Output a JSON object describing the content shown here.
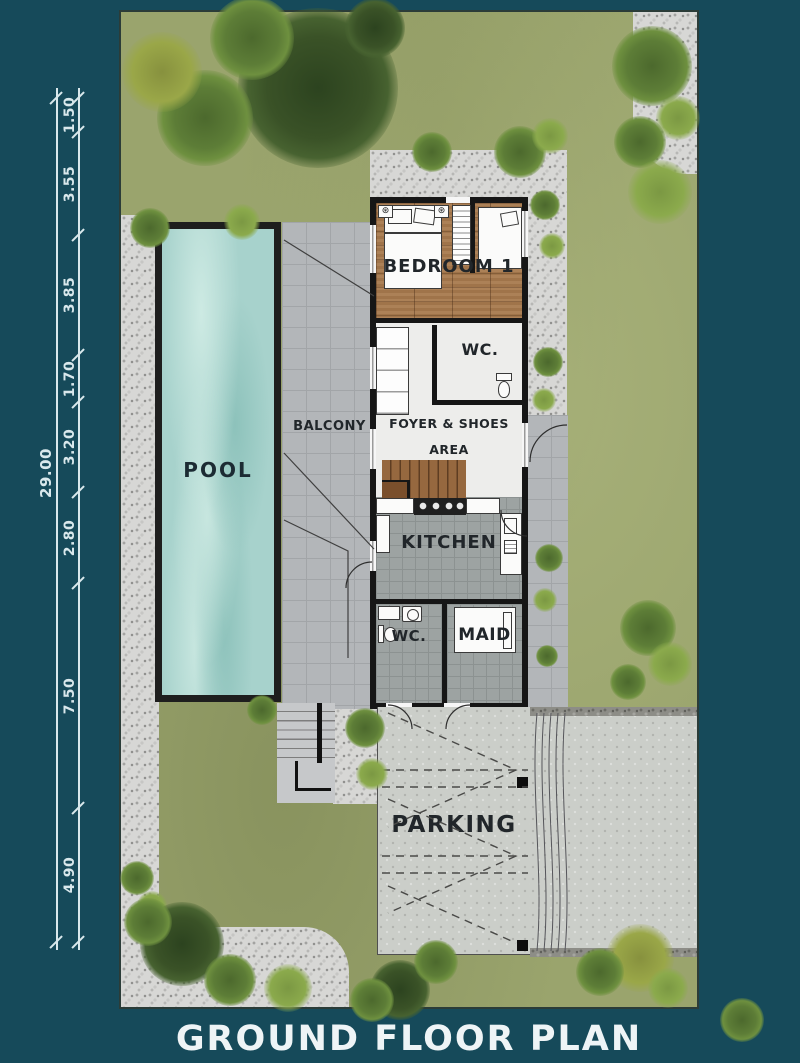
{
  "title": "GROUND FLOOR PLAN",
  "labels": {
    "pool": "POOL",
    "balcony": "BALCONY",
    "bedroom1": "BEDROOM 1",
    "wc_upper": "WC.",
    "foyer_line1": "FOYER & SHOES",
    "foyer_line2": "AREA",
    "kitchen": "KITCHEN",
    "wc_lower": "WC.",
    "maid": "MAID",
    "parking": "PARKING"
  },
  "dimensions": {
    "overall_label": "29.00",
    "overall_center_y": 473,
    "segments": [
      {
        "label": "1.50",
        "center_y": 115
      },
      {
        "label": "3.55",
        "center_y": 184
      },
      {
        "label": "3.85",
        "center_y": 295
      },
      {
        "label": "1.70",
        "center_y": 379
      },
      {
        "label": "3.20",
        "center_y": 447
      },
      {
        "label": "2.80",
        "center_y": 538
      },
      {
        "label": "7.50",
        "center_y": 696
      },
      {
        "label": "4.90",
        "center_y": 875
      }
    ],
    "tick_ys": [
      98,
      132,
      235,
      355,
      402,
      492,
      583,
      808,
      942
    ]
  },
  "colors": {
    "background": "#164a5a",
    "grass": "#9aa46d",
    "pool_water": "#a7d2cc",
    "dimension_lines": "#d9e8ec",
    "room_label_text": "#21262a",
    "title_text": "#eef4f6",
    "walls": "#161616"
  }
}
